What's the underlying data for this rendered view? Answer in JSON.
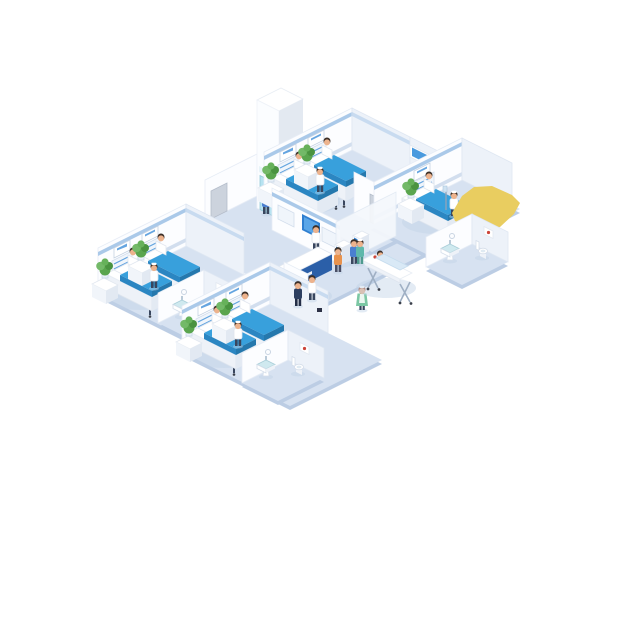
{
  "scene": {
    "title": "Isometric hospital ward floor illustration",
    "background": "#ffffff"
  },
  "palette": {
    "floor": "#d7e2f1",
    "slab": "#bccde4",
    "wall": "#fcfdff",
    "wallShade": "#edf2f9",
    "band": "#aac9e9",
    "baseboard": "#d2deee",
    "accent": "#3f8fd8",
    "blanket": "#38a0dc",
    "blanketSide": "#2b86c2",
    "blanketDark": "#2578ad",
    "deskBlue": "#2b5fa8",
    "deskBlueDark": "#24518f",
    "screenBlue": "#2f7fd0",
    "elevDoor": "#b7e3f1",
    "doorGray": "#ccd3dd",
    "curtainYellow": "#e9cd60",
    "glass": "#f5f8fc",
    "plantDark": "#4a9340",
    "plantMid": "#5aa54e",
    "plantLight": "#73b968",
    "skin": "#edb38d",
    "hair": "#3b2f28",
    "legDark": "#39465e",
    "scrubTeal": "#5fb8ab",
    "scrubGreen": "#7cc7a4",
    "shirtBlue": "#4a7fd0",
    "shirtOrange": "#e8924d",
    "navy": "#2c3e60",
    "shadow": "#c2d2e6",
    "sinkTop": "#cfe9ef"
  },
  "inventory": {
    "rooms": [
      {
        "name": "ward-room-top",
        "beds": 2,
        "patients": 2,
        "nurses": 1
      },
      {
        "name": "ward-room-right",
        "beds": 1,
        "patients": 1,
        "nurses": 1
      },
      {
        "name": "ward-room-left",
        "beds": 2,
        "patients": 2,
        "nurses": 1
      },
      {
        "name": "ward-room-bottom",
        "beds": 2,
        "patients": 2,
        "nurses": 1
      }
    ],
    "lobby": {
      "reception_desk": 1,
      "receptionist": 1,
      "self_service_kiosks": 2,
      "kiosk_users": 2,
      "wall_display_panels": 3,
      "elevator": 1,
      "elevator_waiting": 1,
      "walking_staff": 2,
      "walking_nurse": 1,
      "stretcher": {
        "patients": 1,
        "porter": 1
      }
    },
    "bathrooms": 3,
    "sinks": 4,
    "toilets": 3,
    "plants": 7,
    "highlight": {
      "shape": "yellow-curtain",
      "location": "top-right-room-corner"
    }
  }
}
